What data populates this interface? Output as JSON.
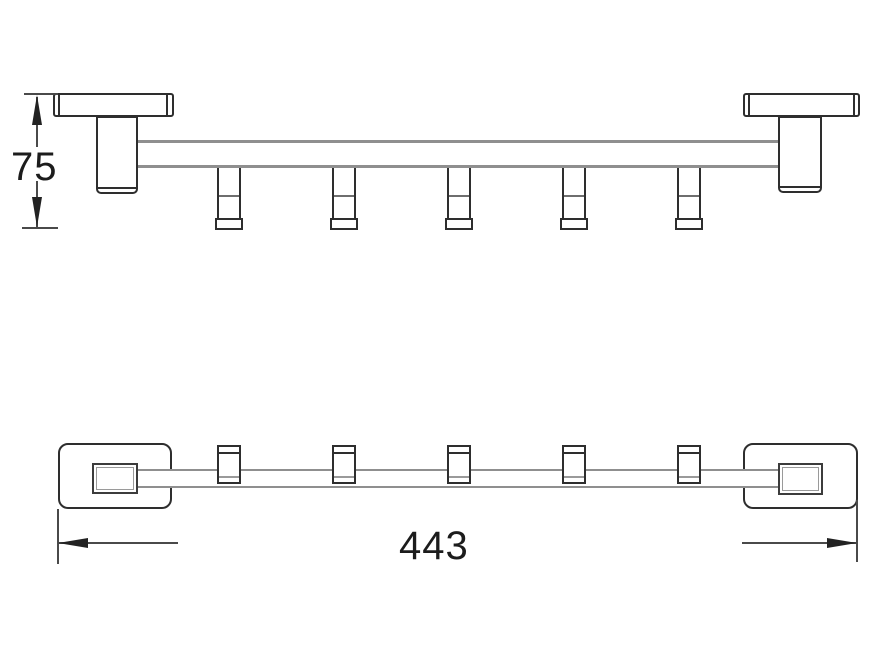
{
  "page": {
    "background": "#ffffff",
    "content": "technical line drawing of a 5-hook towel bar, front view and top view with dimensions"
  },
  "dimensions": {
    "height": {
      "value": "75"
    },
    "length": {
      "value": "443"
    }
  },
  "drawing": {
    "front_view": {
      "hook_count": 5,
      "wall_plate_count": 2
    },
    "top_view": {
      "hook_count": 5,
      "wall_plate_count": 2
    },
    "colors": {
      "outline": "#2e2e2e",
      "bar_line": "#8f8f8f",
      "dimension_line": "#4a4a4a",
      "arrow_fill": "#222222",
      "text": "#1c1c1c",
      "background": "#ffffff"
    }
  }
}
